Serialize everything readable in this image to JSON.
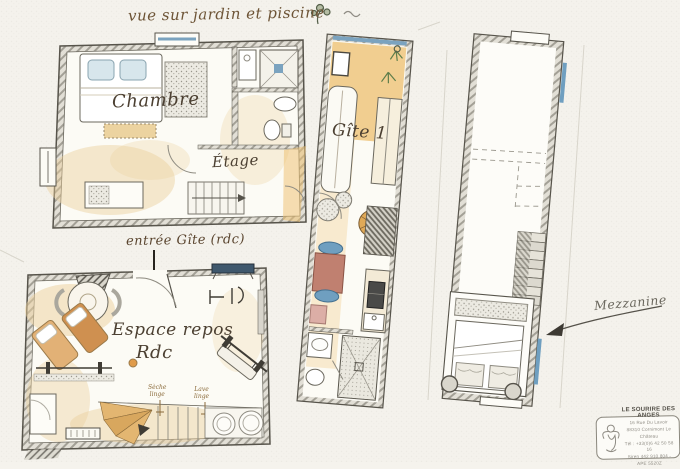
{
  "title": {
    "text": "vue sur jardin et piscine"
  },
  "labels": {
    "chambre": "Chambre",
    "etage": "Étage",
    "gite1": "Gîte 1",
    "entree_gite": "entrée Gîte (rdc)",
    "espace_repos": "Espace repos",
    "rdc": "Rdc",
    "seche_linge_line1": "Sèche",
    "seche_linge_line2": "linge",
    "lave_linge_line1": "Lave",
    "lave_linge_line2": "linge",
    "mezzanine": "Mezzanine"
  },
  "stamp": {
    "name": "LE SOURIRE DES ANGES",
    "line1": "16 Rue Du Lavoir",
    "line2": "88310 Cornimont Le Château",
    "line3": "Tél : +33(0)6 42 50 58 16",
    "line4": "Siren 442 910 804 - APE 5520Z"
  },
  "colors": {
    "paper": "#f5f3ed",
    "ink": "#55524a",
    "sepia_text": "#5a452f",
    "floor_tan": "#e8c07a",
    "accent_blue": "#6f9fc0",
    "table_red": "#c08070",
    "plant_green": "#5d7d4a"
  }
}
